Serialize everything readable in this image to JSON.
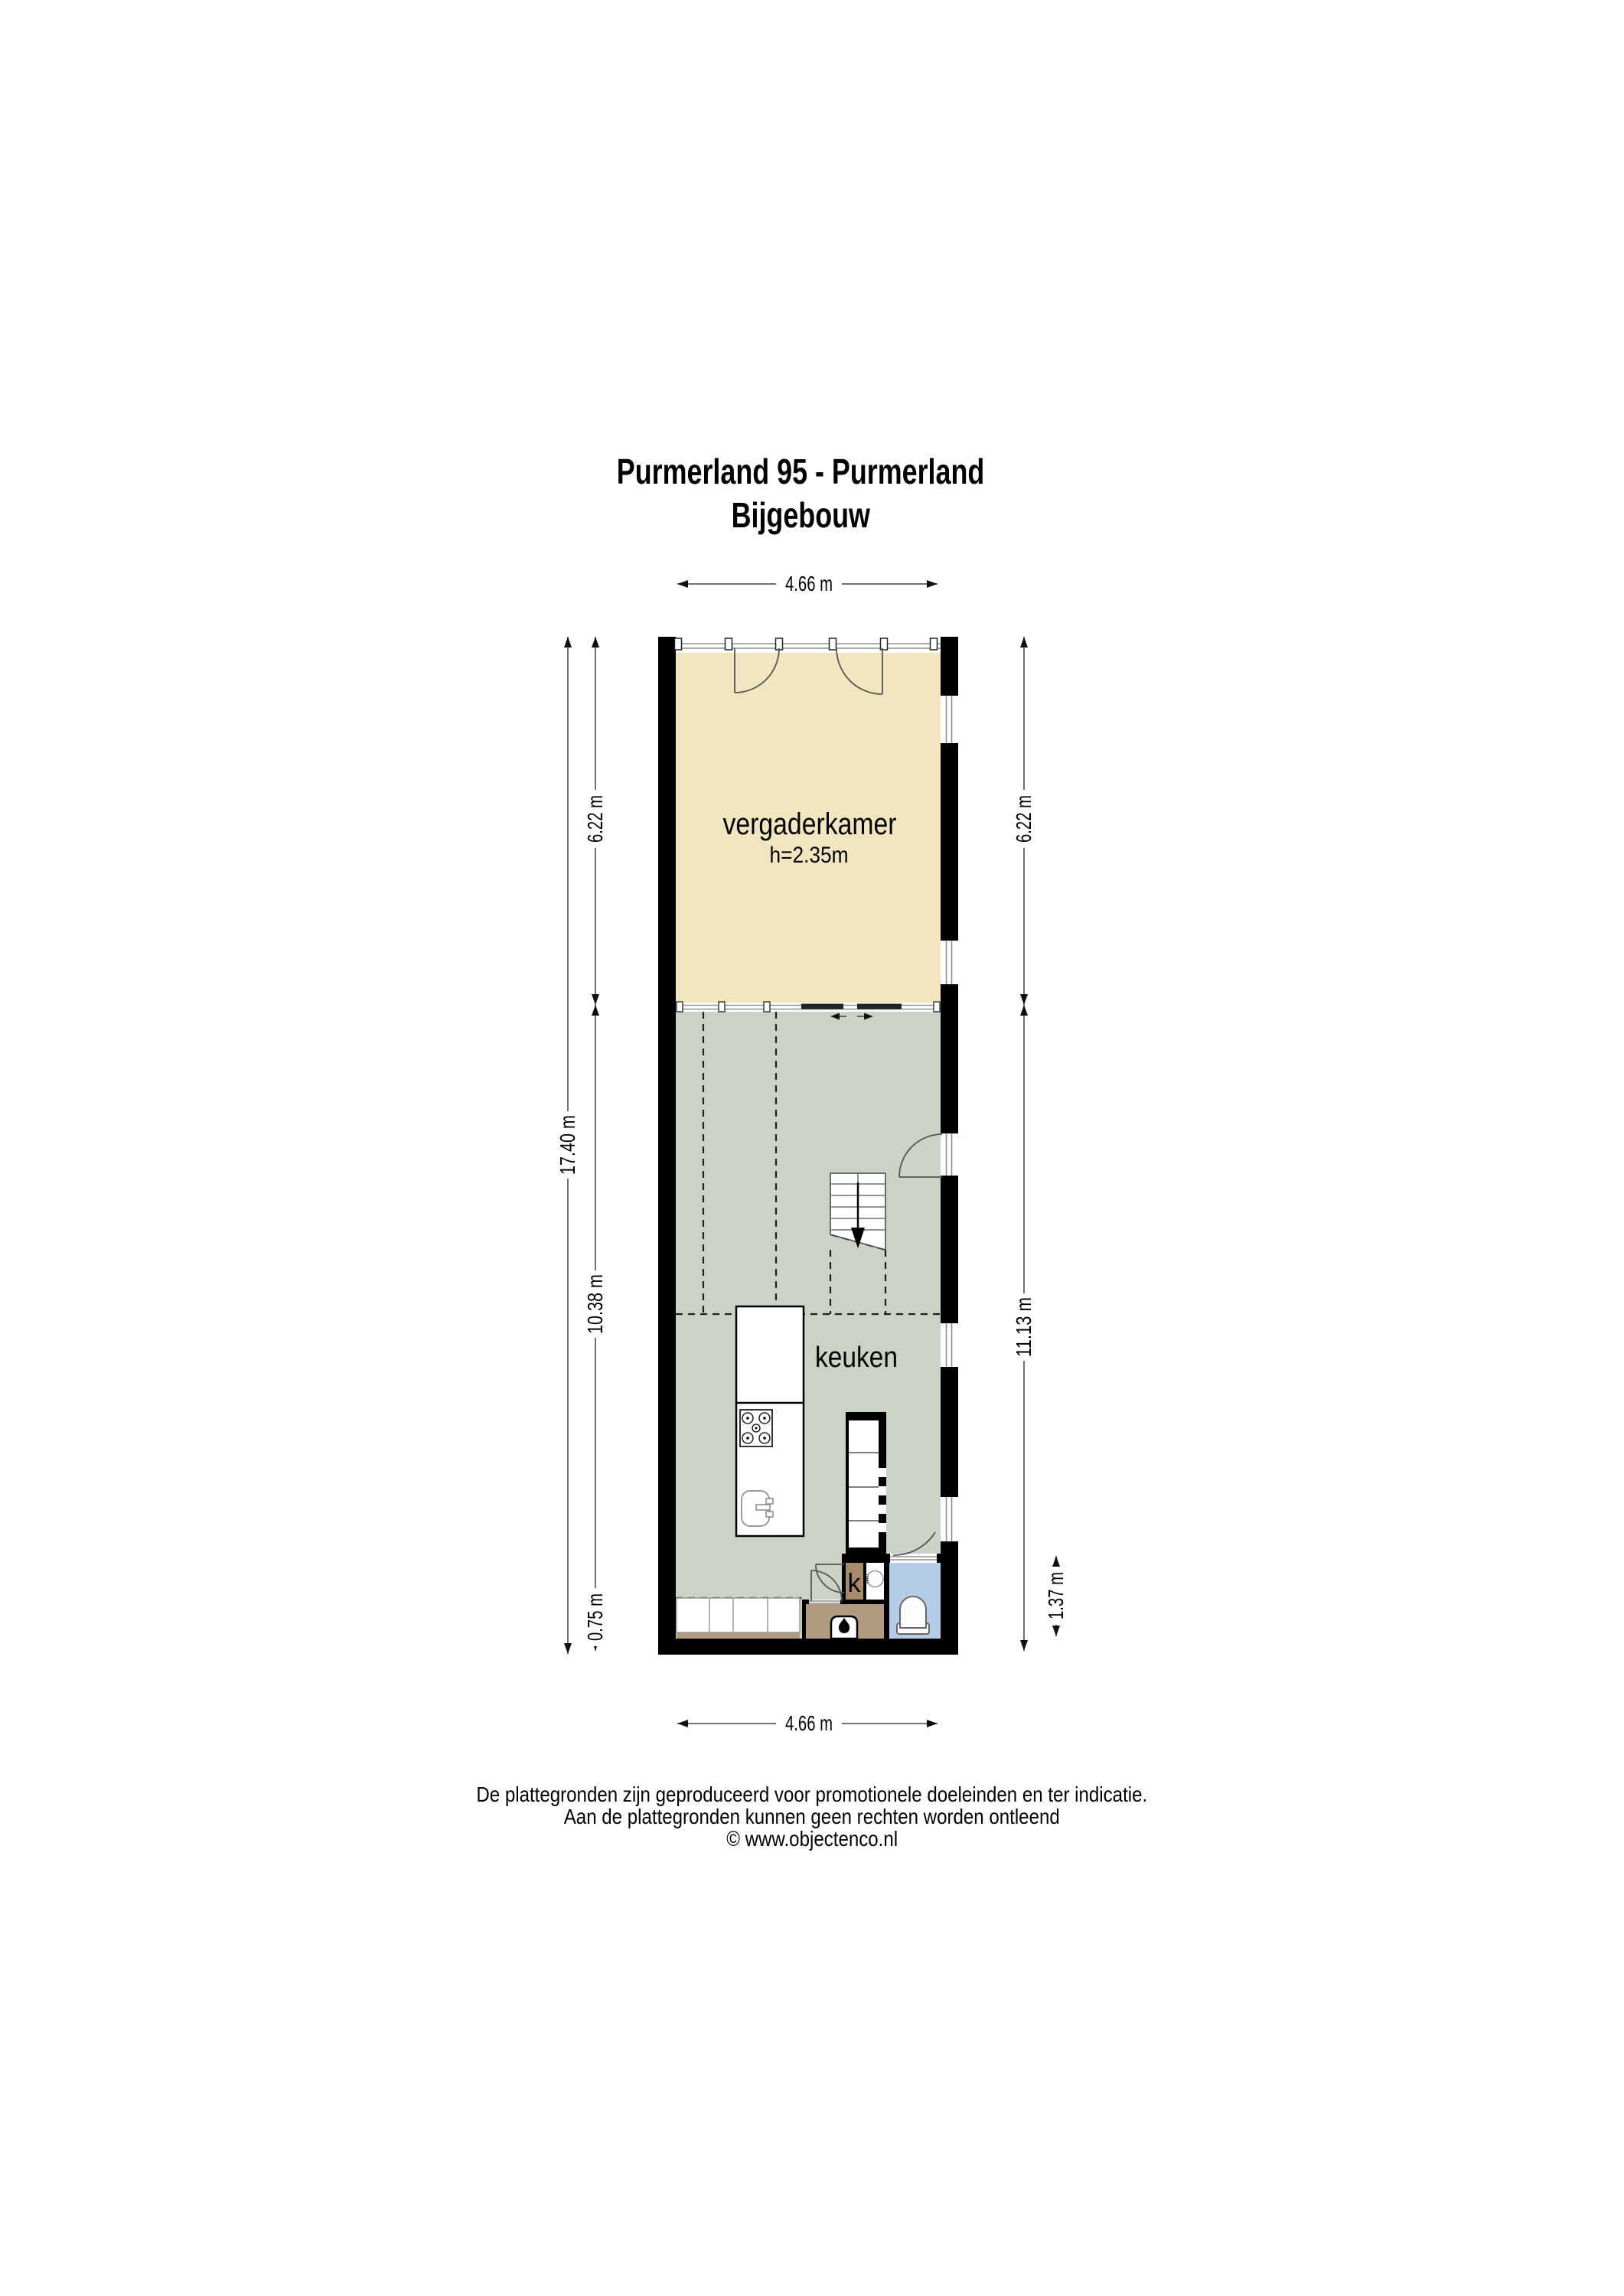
{
  "title": {
    "line1": "Purmerland 95 - Purmerland",
    "line2": "Bijgebouw"
  },
  "rooms": {
    "meeting": {
      "label": "vergaderkamer",
      "height_note": "h=2.35m",
      "color": "#f2e6c1"
    },
    "kitchen": {
      "label": "keuken",
      "color": "#cbd3c7"
    },
    "closet": {
      "label": "k",
      "color": "#a58b6b"
    },
    "utility": {
      "label": "wm",
      "color": "#ffffff"
    },
    "bathroom": {
      "color": "#b5cce7"
    },
    "stove_area": {
      "color": "#b19b7e"
    }
  },
  "dimensions": {
    "top_width": "4.66 m",
    "bottom_width": "4.66 m",
    "left_total": "17.40 m",
    "left_upper": "6.22 m",
    "left_middle": "10.38 m",
    "left_lower": "0.75 m",
    "right_upper": "6.22 m",
    "right_lower": "11.13 m",
    "bath_depth": "1.37 m"
  },
  "footer": {
    "line1": "De plattegronden zijn geproduceerd voor promotionele doeleinden en ter indicatie.",
    "line2": "Aan de plattegronden kunnen geen rechten worden ontleend",
    "line3": "© www.objectenco.nl"
  },
  "colors": {
    "wall": "#000000",
    "dash": "#1f1f1f",
    "accent_cream": "#f2e6c1",
    "accent_green": "#cbd3c7",
    "accent_blue": "#b5cce7",
    "accent_tan": "#b19b7e"
  }
}
